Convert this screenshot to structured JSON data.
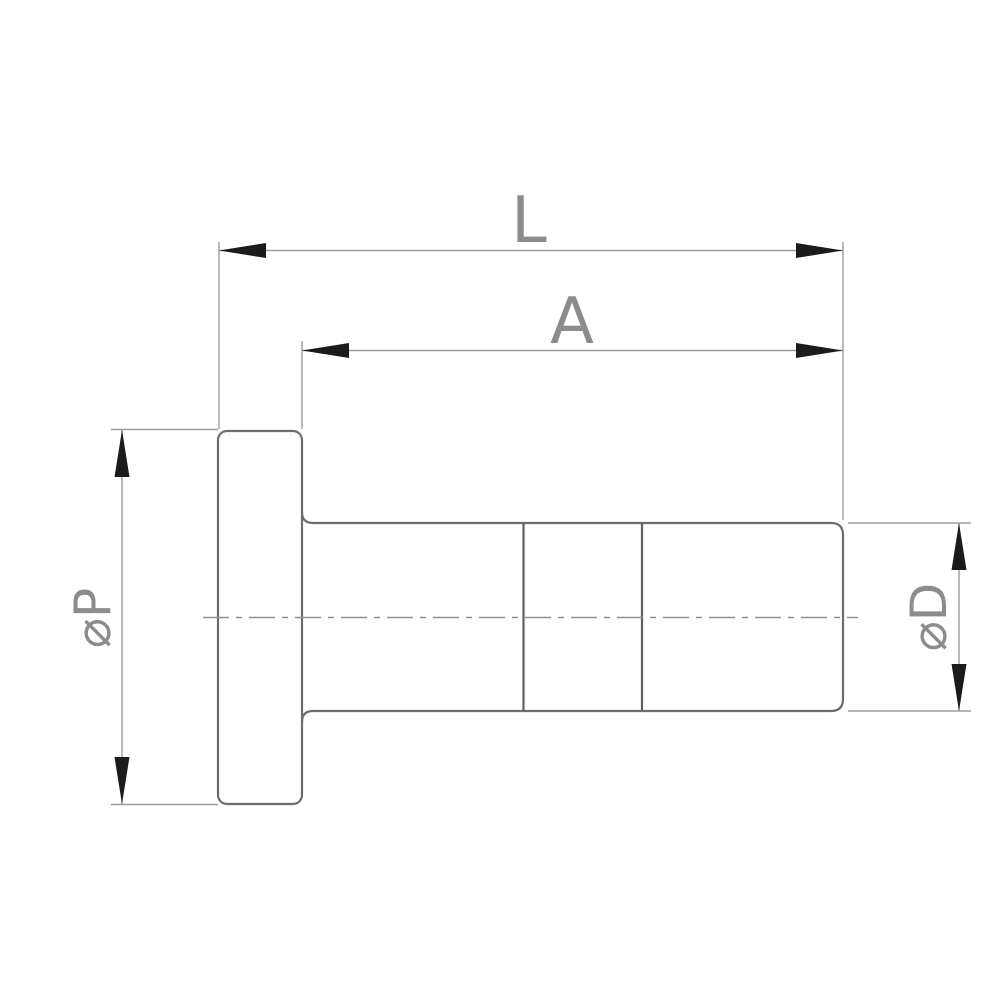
{
  "diagram": {
    "type": "technical-dimension-drawing",
    "labels": {
      "L": "L",
      "A": "A",
      "P": "⌀P",
      "D": "⌀D"
    },
    "colors": {
      "background": "#ffffff",
      "outline": "#6d6d6d",
      "section_line": "#606060",
      "dimension": "#9c9c9c",
      "centerline": "#8f8f8f",
      "arrow": "#1b1b1b",
      "label": "#8c8c8c"
    }
  }
}
